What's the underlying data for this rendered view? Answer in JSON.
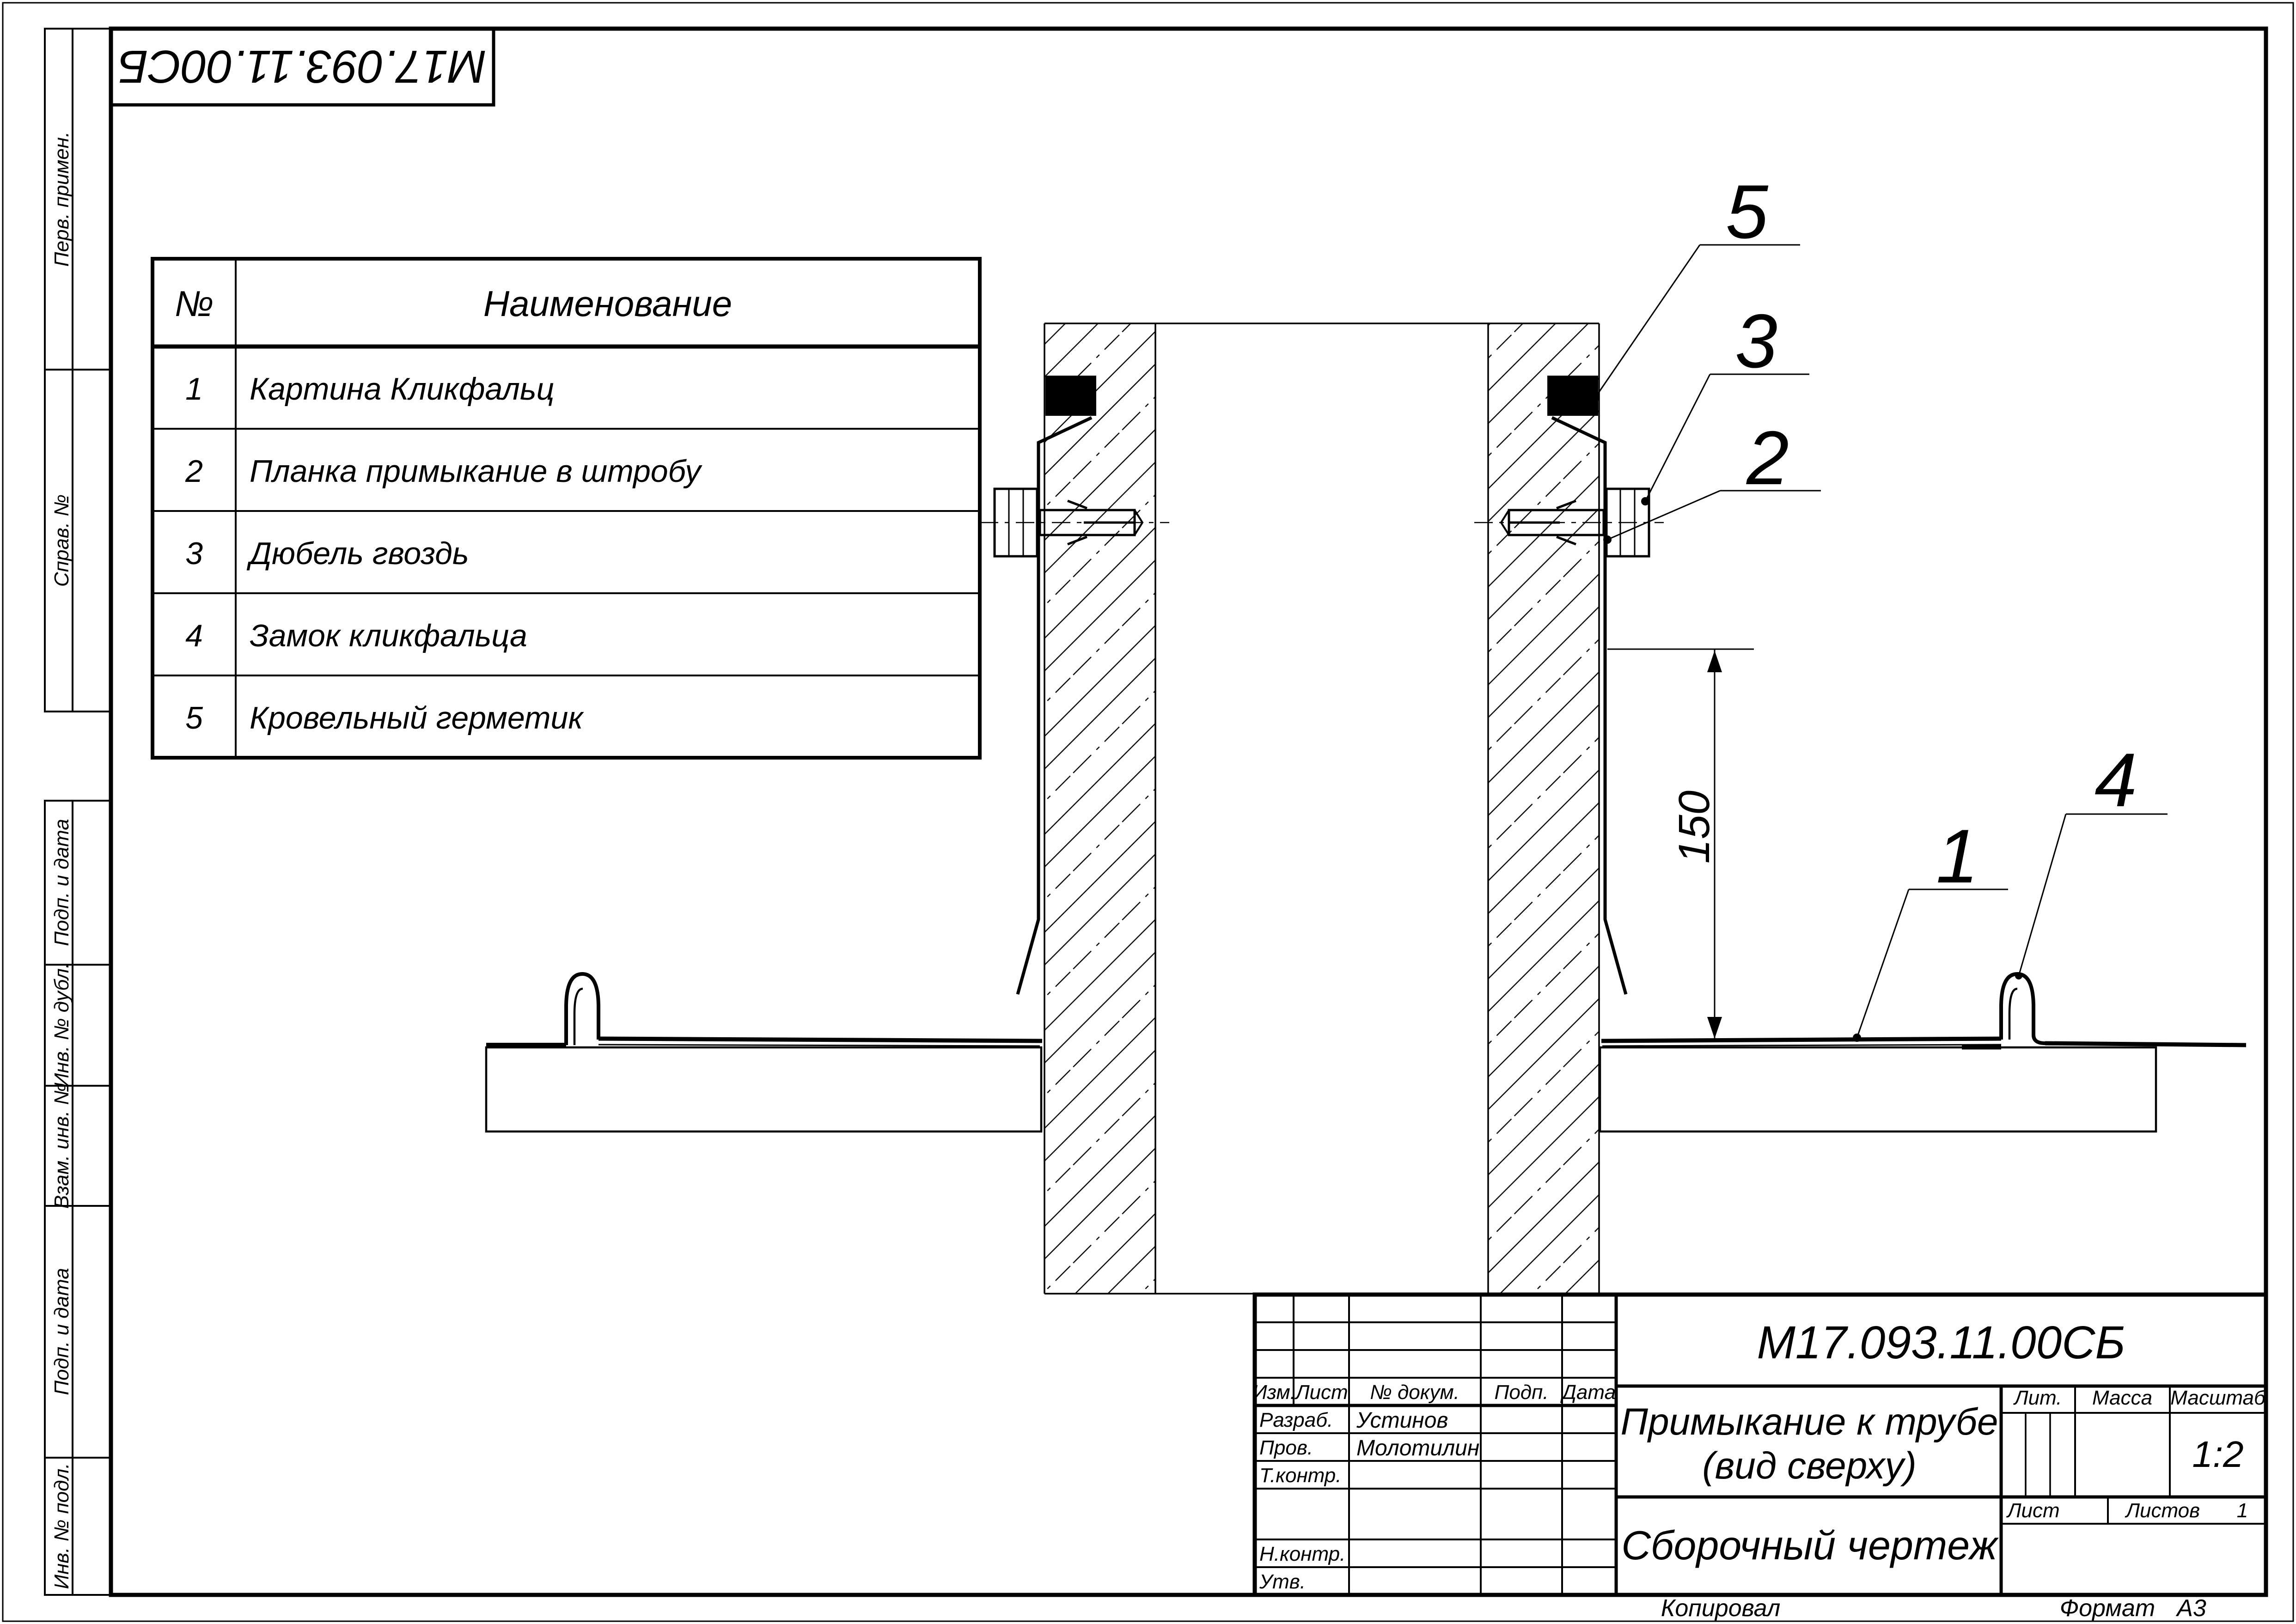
{
  "doc": {
    "code": "М17.093.11.00СБ"
  },
  "margin_labels": {
    "perv": "Перв. примен.",
    "sprav": "Справ. №",
    "podp1": "Подп. и дата",
    "inv_dubl": "Инв. № дубл.",
    "vzam": "Взам. инв. №",
    "podp2": "Подп. и дата",
    "inv_podl": "Инв. № подл."
  },
  "parts_table": {
    "col_num": "№",
    "col_name": "Наименование",
    "rows": [
      {
        "num": "1",
        "name": "Картина Кликфальц"
      },
      {
        "num": "2",
        "name": "Планка примыкание в штробу"
      },
      {
        "num": "3",
        "name": "Дюбель гвоздь"
      },
      {
        "num": "4",
        "name": "Замок кликфальца"
      },
      {
        "num": "5",
        "name": "Кровельный герметик"
      }
    ]
  },
  "drawing": {
    "callout_5": "5",
    "callout_3": "3",
    "callout_2": "2",
    "callout_1": "1",
    "callout_4": "4",
    "dim_150": "150"
  },
  "title_block": {
    "code": "М17.093.11.00СБ",
    "title_line1": "Примыкание к трубе",
    "title_line2": "(вид сверху)",
    "doc_type": "Сборочный чертеж",
    "labels": {
      "izm": "Изм.",
      "list": "Лист",
      "dokum": "№ докум.",
      "podp": "Подп.",
      "data": "Дата",
      "razrab": "Разраб.",
      "prov": "Пров.",
      "tkontr": "Т.контр.",
      "nkontr": "Н.контр.",
      "utv": "Утв.",
      "lit": "Лит.",
      "massa": "Масса",
      "masshtab": "Масштаб",
      "list2": "Лист",
      "listov": "Листов"
    },
    "values": {
      "razrab_name": "Устинов",
      "prov_name": "Молотилин",
      "scale": "1:2",
      "listov_value": "1"
    }
  },
  "footer": {
    "kopiroval": "Копировал",
    "format_label": "Формат",
    "format_value": "А3"
  }
}
